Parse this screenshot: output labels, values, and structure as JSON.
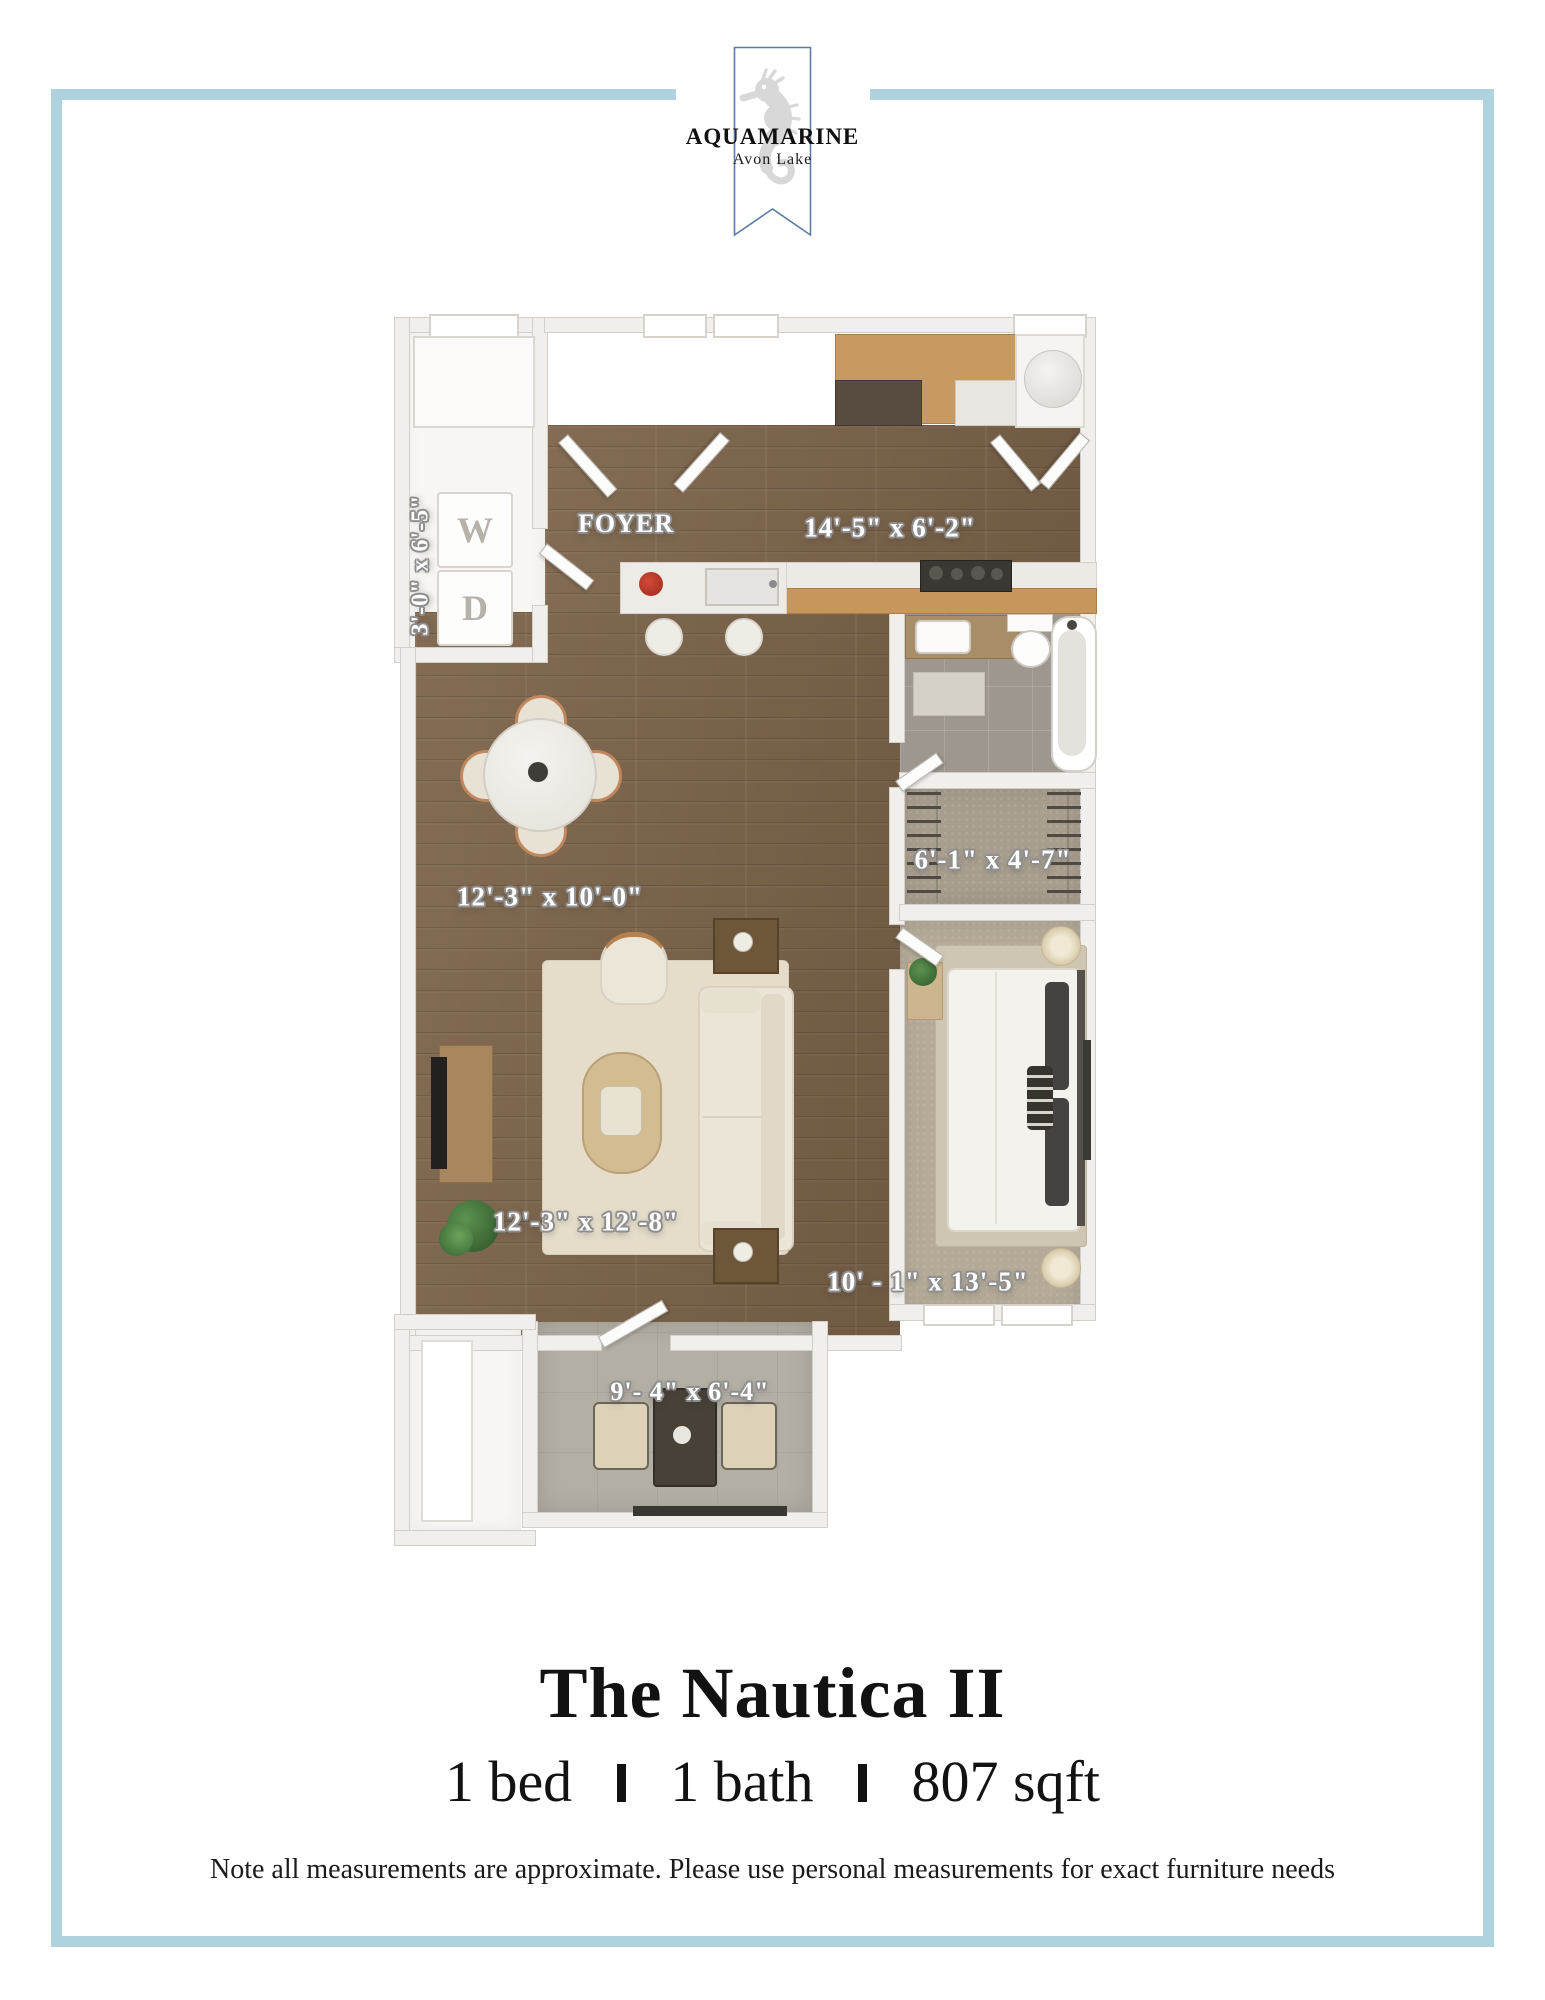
{
  "logo": {
    "name": "AQUAMARINE",
    "subname": "Avon Lake",
    "icon": "seahorse-icon"
  },
  "colors": {
    "frame_border": "#aed3de",
    "banner_outline": "#5d7ca3",
    "wood_floor": "#7c6349",
    "bedroom_carpet": "#b5aa98",
    "patio_concrete": "#b4afa5",
    "text": "#121212"
  },
  "floorplan": {
    "rooms": {
      "laundry": {
        "label": "3'-0\" x 6'-5\"",
        "washer": "W",
        "dryer": "D"
      },
      "foyer": {
        "label": "FOYER"
      },
      "kitchen": {
        "label": "14'-5\" x 6'-2\""
      },
      "closet": {
        "label": "6'-1\" x 4'-7\""
      },
      "dining": {
        "label": "12'-3\" x 10'-0\""
      },
      "living": {
        "label": "12'-3\" x 12'-8\""
      },
      "bedroom": {
        "label": "10' - 1\" x 13'-5\""
      },
      "patio": {
        "label": "9'- 4\" x 6'-4\""
      }
    }
  },
  "footer": {
    "title": "The Nautica II",
    "specs": [
      {
        "label": "1 bed"
      },
      {
        "label": "1 bath"
      },
      {
        "label": "807 sqft"
      }
    ],
    "separator": "|",
    "note": "Note all measurements are approximate. Please use personal measurements for exact furniture needs"
  }
}
